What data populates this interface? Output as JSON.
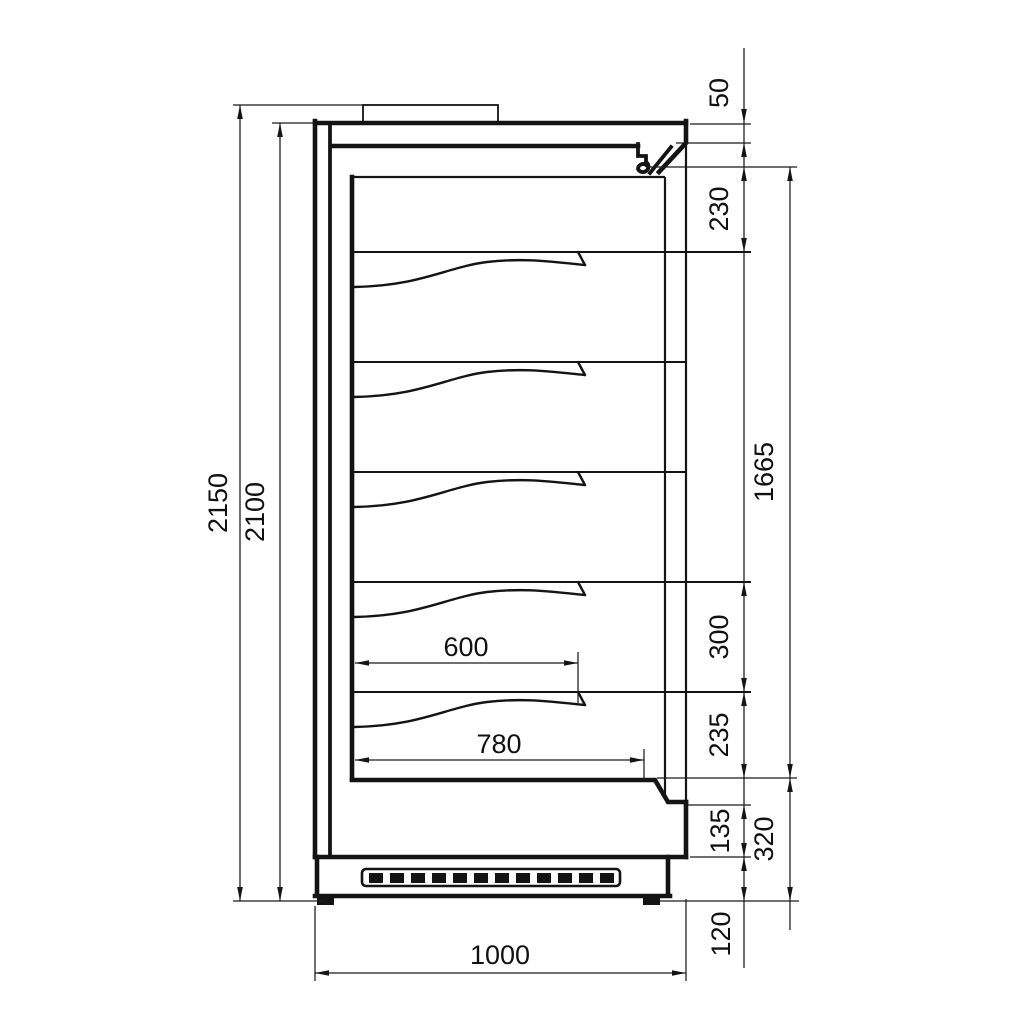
{
  "dims": {
    "overall_height": "2150",
    "body_height": "2100",
    "canopy_front_height": "50",
    "canopy_to_first_shelf": "230",
    "display_opening_height": "1665",
    "bottom_shelf_spacing": "300",
    "bottom_shelf_to_deck": "235",
    "front_panel_height": "135",
    "deck_height": "320",
    "plinth_height": "120",
    "shelf_depth": "600",
    "deck_depth": "780",
    "overall_depth": "1000"
  }
}
